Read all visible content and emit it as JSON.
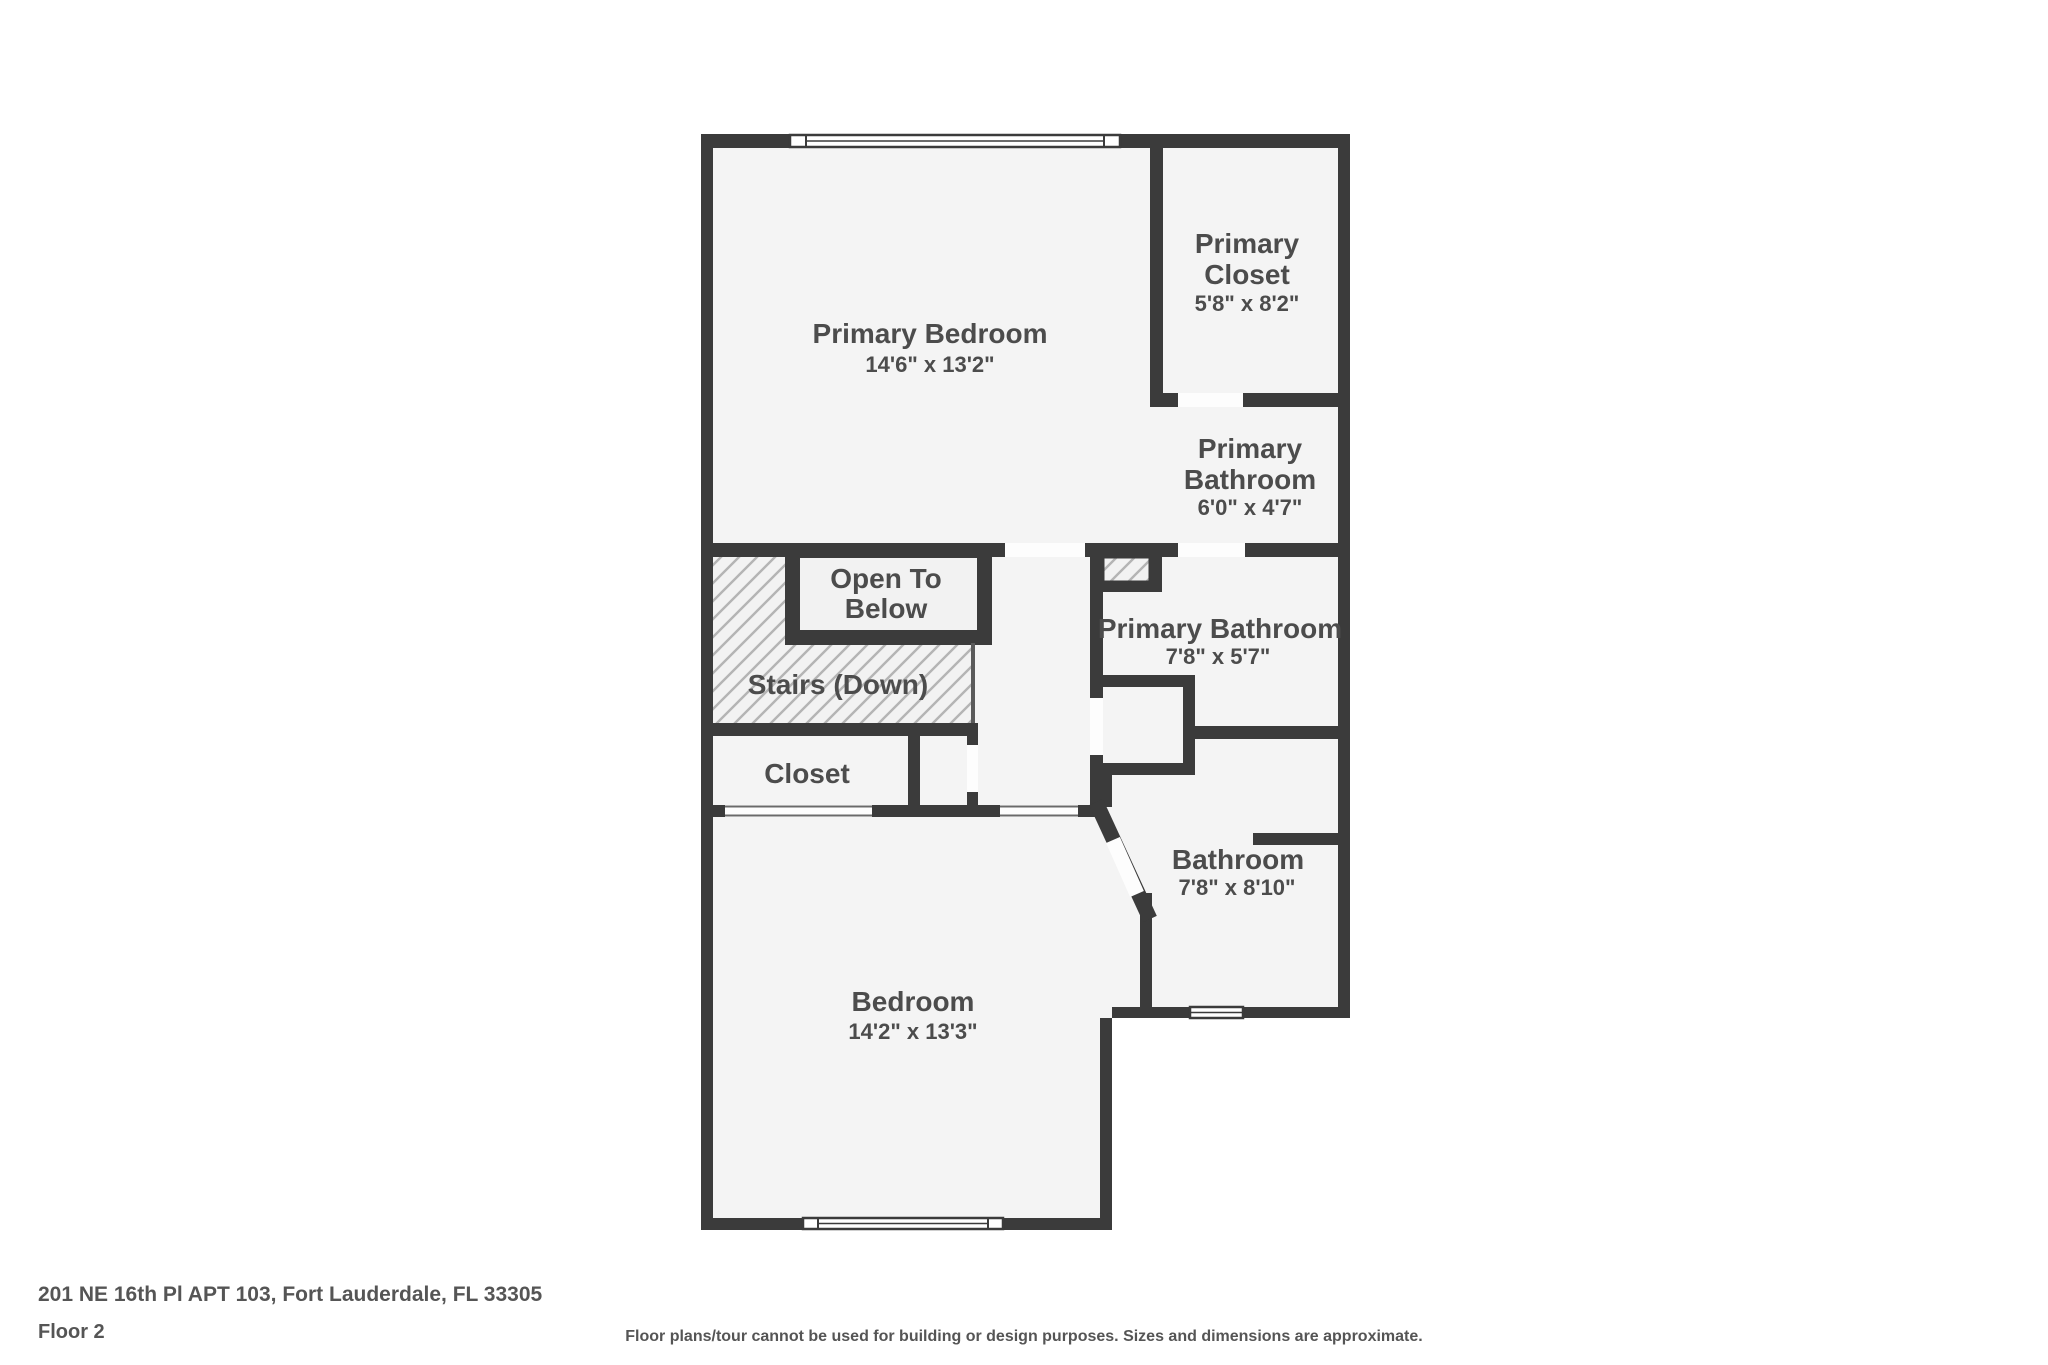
{
  "plan": {
    "colors": {
      "wall": "#3b3b3b",
      "floor": "#f4f4f4",
      "hatch_line": "#b4b4b4",
      "label_text": "#4c4c4c"
    },
    "rooms": {
      "primary_bedroom": {
        "name": "Primary Bedroom",
        "dims": "14'6\" x 13'2\""
      },
      "primary_closet": {
        "name_line1": "Primary",
        "name_line2": "Closet",
        "dims": "5'8\" x 8'2\""
      },
      "primary_bathroom_upper": {
        "name_line1": "Primary",
        "name_line2": "Bathroom",
        "dims": "6'0\" x 4'7\""
      },
      "open_to_below": {
        "label_line1": "Open To",
        "label_line2": "Below"
      },
      "stairs": {
        "label": "Stairs (Down)"
      },
      "closet": {
        "label": "Closet"
      },
      "primary_bathroom": {
        "name": "Primary Bathroom",
        "dims": "7'8\" x 5'7\""
      },
      "bathroom": {
        "name": "Bathroom",
        "dims": "7'8\" x 8'10\""
      },
      "bedroom": {
        "name": "Bedroom",
        "dims": "14'2\" x 13'3\""
      }
    }
  },
  "footer": {
    "address": "201 NE 16th Pl APT 103, Fort Lauderdale, FL 33305",
    "floor_label": "Floor 2",
    "disclaimer": "Floor plans/tour cannot be used for building or design purposes. Sizes and dimensions are approximate."
  }
}
